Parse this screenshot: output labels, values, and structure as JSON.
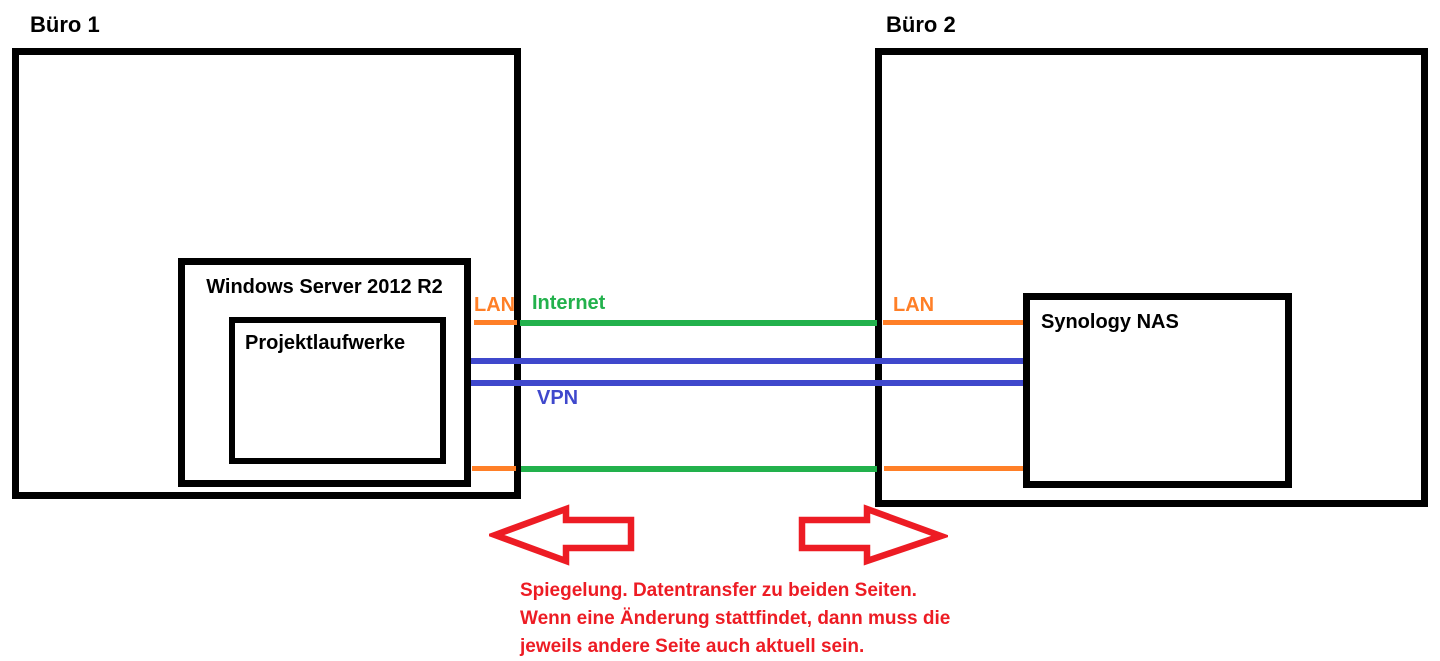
{
  "office1": {
    "label": "Büro 1",
    "lan_label": "LAN",
    "server": {
      "label": "Windows Server 2012 R2"
    },
    "drives": {
      "label": "Projektlaufwerke"
    }
  },
  "office2": {
    "label": "Büro 2",
    "lan_label": "LAN",
    "nas": {
      "label": "Synology NAS"
    }
  },
  "links": {
    "internet_label": "Internet",
    "vpn_label": "VPN"
  },
  "note": {
    "lines": [
      "Spiegelung. Datentransfer zu beiden Seiten.",
      "Wenn eine Änderung stattfindet, dann muss die",
      "jeweils andere Seite auch aktuell sein."
    ]
  },
  "colors": {
    "lan_orange": "#FF7F27",
    "internet_green": "#22B14C",
    "vpn_blue": "#3F48CC",
    "annotation_red": "#ED1C24",
    "box_black": "#000000",
    "background": "#FFFFFF"
  }
}
